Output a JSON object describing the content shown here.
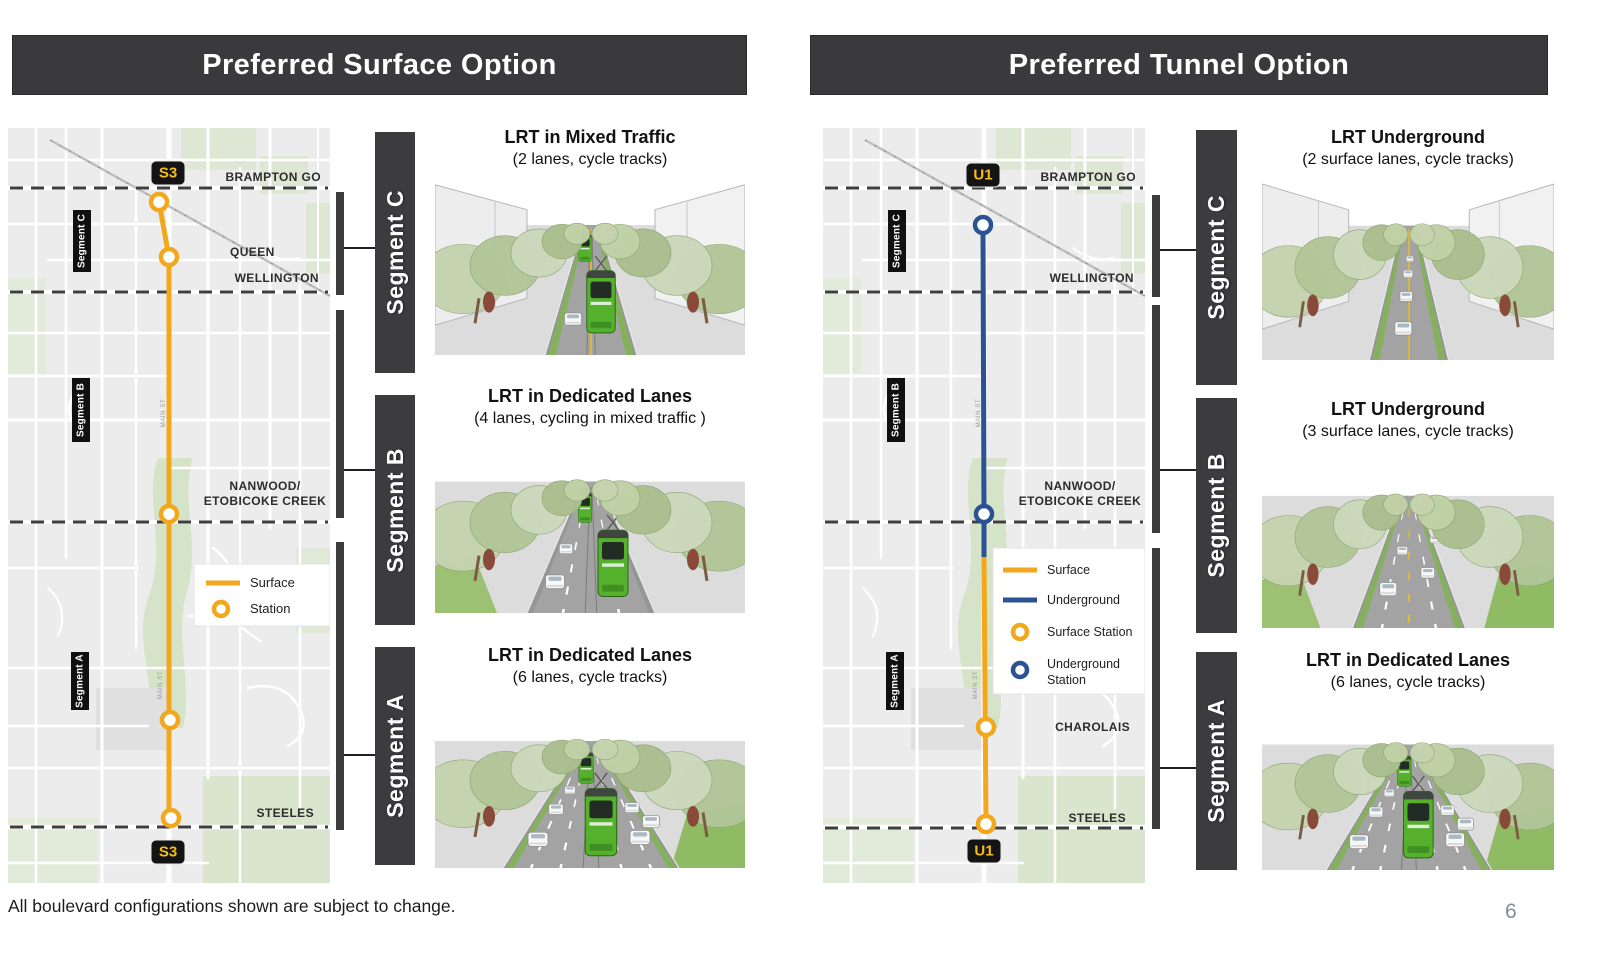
{
  "page": {
    "footnote": "All boulevard configurations shown are subject to change.",
    "page_number": "6"
  },
  "colors": {
    "surface": "#F2A71D",
    "underground": "#2B5394",
    "header_bg": "#3A3A3C",
    "bar_bg": "#3C3C3E",
    "badge_bg": "#141414",
    "badge_text": "#F6BE16"
  },
  "panels": {
    "surface": {
      "title": "Preferred Surface Option",
      "map": {
        "badge_top": "S3",
        "badge_bottom": "S3",
        "road_label": "MAIN ST",
        "labels": {
          "brampton_go": "BRAMPTON GO",
          "queen": "QUEEN",
          "wellington": "WELLINGTON",
          "nanwood_line1": "NANWOOD/",
          "nanwood_line2": "ETOBICOKE CREEK",
          "steeles": "STEELES"
        },
        "segments": {
          "c": "Segment C",
          "b": "Segment B",
          "a": "Segment A"
        },
        "legend": {
          "surface": "Surface",
          "station": "Station"
        }
      },
      "segment_bars": {
        "c": "Segment C",
        "b": "Segment B",
        "a": "Segment A"
      },
      "captions": {
        "c_title": "LRT in Mixed Traffic",
        "c_sub": "(2 lanes, cycle tracks)",
        "b_title": "LRT in Dedicated Lanes",
        "b_sub": "(4 lanes, cycling in mixed traffic )",
        "a_title": "LRT in Dedicated Lanes",
        "a_sub": "(6 lanes, cycle tracks)"
      }
    },
    "tunnel": {
      "title": "Preferred Tunnel Option",
      "map": {
        "badge_top": "U1",
        "badge_bottom": "U1",
        "road_label": "MAIN ST",
        "labels": {
          "brampton_go": "BRAMPTON GO",
          "wellington": "WELLINGTON",
          "nanwood_line1": "NANWOOD/",
          "nanwood_line2": "ETOBICOKE CREEK",
          "charolais": "CHAROLAIS",
          "steeles": "STEELES"
        },
        "segments": {
          "c": "Segment C",
          "b": "Segment B",
          "a": "Segment A"
        },
        "legend": {
          "surface": "Surface",
          "underground": "Underground",
          "surface_station": "Surface Station",
          "underground_station_line1": "Underground",
          "underground_station_line2": "Station"
        }
      },
      "segment_bars": {
        "c": "Segment C",
        "b": "Segment B",
        "a": "Segment A"
      },
      "captions": {
        "c_title": "LRT Underground",
        "c_sub": "(2 surface lanes, cycle tracks)",
        "b_title": "LRT Underground",
        "b_sub": "(3 surface lanes, cycle tracks)",
        "a_title": "LRT in Dedicated Lanes",
        "a_sub": "(6 lanes, cycle tracks)"
      }
    }
  }
}
